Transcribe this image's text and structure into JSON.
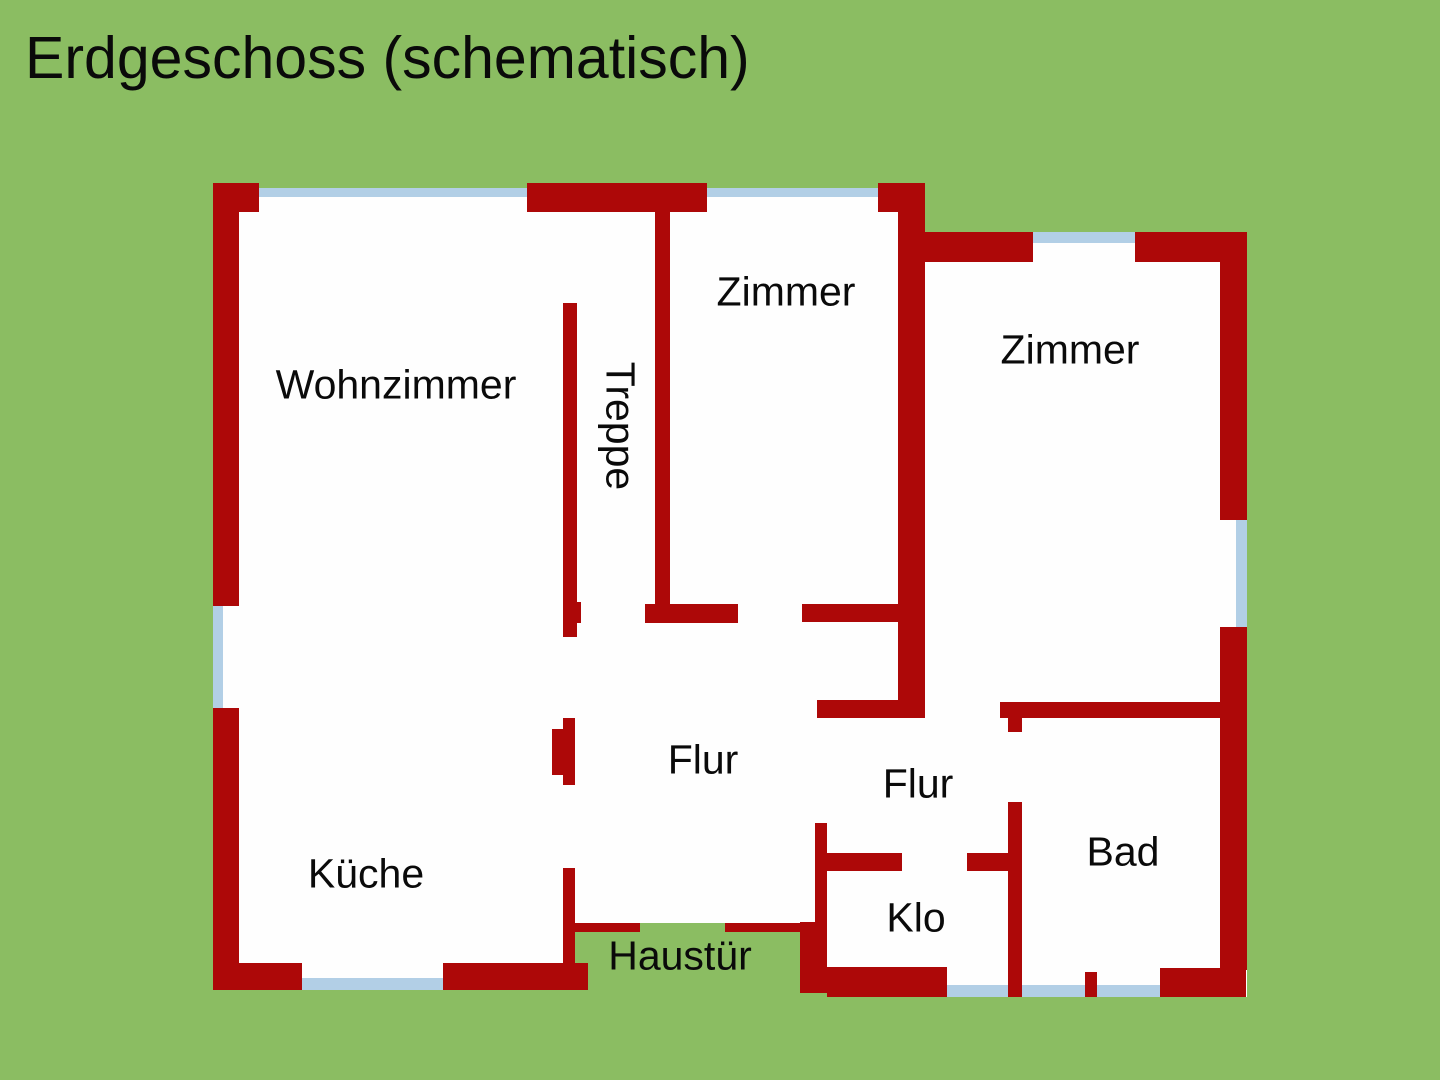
{
  "title": {
    "text": "Erdgeschoss (schematisch)"
  },
  "colors": {
    "background": "#8BBD62",
    "wall": "#AD0808",
    "window": "#B2CFE6",
    "interior": "#FEFEFE",
    "text": "#0A0A0A"
  },
  "canvas": {
    "width": 1440,
    "height": 1080
  },
  "floorplan": {
    "interior": [
      {
        "x": 213,
        "y": 183,
        "w": 712,
        "h": 807
      },
      {
        "x": 898,
        "y": 232,
        "w": 349,
        "h": 765
      }
    ],
    "green_overlays": [
      {
        "x": 259,
        "y": 183,
        "w": 268,
        "h": 5
      },
      {
        "x": 707,
        "y": 183,
        "w": 171,
        "h": 5
      },
      {
        "x": 640,
        "y": 923,
        "w": 85,
        "h": 70
      },
      {
        "x": 575,
        "y": 932,
        "w": 225,
        "h": 60
      }
    ],
    "windows": [
      {
        "name": "window-top-left",
        "x": 259,
        "y": 188,
        "w": 268,
        "h": 9
      },
      {
        "name": "window-top-middle",
        "x": 707,
        "y": 188,
        "w": 171,
        "h": 9
      },
      {
        "name": "window-top-right",
        "x": 1033,
        "y": 232,
        "w": 102,
        "h": 11
      },
      {
        "name": "window-left-wall",
        "x": 213,
        "y": 606,
        "w": 10,
        "h": 102
      },
      {
        "name": "window-right-wall",
        "x": 1236,
        "y": 520,
        "w": 11,
        "h": 107
      },
      {
        "name": "window-bottom-kueche",
        "x": 302,
        "y": 978,
        "w": 141,
        "h": 12
      },
      {
        "name": "window-bottom-klo",
        "x": 947,
        "y": 985,
        "w": 61,
        "h": 12
      },
      {
        "name": "window-bottom-bad-left",
        "x": 1022,
        "y": 985,
        "w": 63,
        "h": 12
      },
      {
        "name": "window-bottom-bad-right",
        "x": 1097,
        "y": 985,
        "w": 63,
        "h": 12
      }
    ],
    "walls": [
      {
        "name": "wall-top-left-corner",
        "x": 213,
        "y": 183,
        "w": 46,
        "h": 29
      },
      {
        "name": "wall-top-middle",
        "x": 527,
        "y": 183,
        "w": 180,
        "h": 29
      },
      {
        "name": "wall-top-block",
        "x": 878,
        "y": 183,
        "w": 47,
        "h": 29
      },
      {
        "name": "wall-left-upper",
        "x": 213,
        "y": 212,
        "w": 26,
        "h": 394
      },
      {
        "name": "wall-left-lower",
        "x": 213,
        "y": 708,
        "w": 26,
        "h": 282
      },
      {
        "name": "wall-bottom-kueche-left",
        "x": 213,
        "y": 963,
        "w": 89,
        "h": 27
      },
      {
        "name": "wall-bottom-kueche-right",
        "x": 443,
        "y": 963,
        "w": 145,
        "h": 27
      },
      {
        "name": "wall-treppe-zimmer",
        "x": 655,
        "y": 212,
        "w": 15,
        "h": 392
      },
      {
        "name": "wall-middle-vertical",
        "x": 898,
        "y": 212,
        "w": 27,
        "h": 506
      },
      {
        "name": "wall-treppe",
        "x": 563,
        "y": 303,
        "w": 14,
        "h": 334
      },
      {
        "name": "wall-treppe-nub",
        "x": 563,
        "y": 602,
        "w": 18,
        "h": 21
      },
      {
        "name": "wall-treppe-foot",
        "x": 645,
        "y": 604,
        "w": 93,
        "h": 19
      },
      {
        "name": "wall-zimmer-flur",
        "x": 802,
        "y": 604,
        "w": 96,
        "h": 18
      },
      {
        "name": "wall-middle-foot",
        "x": 817,
        "y": 700,
        "w": 106,
        "h": 18
      },
      {
        "name": "wall-door-jamb",
        "x": 563,
        "y": 718,
        "w": 12,
        "h": 67
      },
      {
        "name": "wall-door-jamb-bump",
        "x": 552,
        "y": 729,
        "w": 11,
        "h": 46
      },
      {
        "name": "wall-lower-left-vertical",
        "x": 563,
        "y": 868,
        "w": 12,
        "h": 122
      },
      {
        "name": "wall-haustuer-strip-left",
        "x": 575,
        "y": 923,
        "w": 65,
        "h": 9
      },
      {
        "name": "wall-haustuer-strip-right",
        "x": 725,
        "y": 923,
        "w": 75,
        "h": 9
      },
      {
        "name": "wall-haustuer-block",
        "x": 800,
        "y": 922,
        "w": 27,
        "h": 71
      },
      {
        "name": "wall-top-right-left",
        "x": 920,
        "y": 232,
        "w": 113,
        "h": 30
      },
      {
        "name": "wall-top-right-corner",
        "x": 1135,
        "y": 232,
        "w": 112,
        "h": 30
      },
      {
        "name": "wall-right-upper",
        "x": 1220,
        "y": 232,
        "w": 27,
        "h": 288
      },
      {
        "name": "wall-right-lower",
        "x": 1220,
        "y": 627,
        "w": 27,
        "h": 343
      },
      {
        "name": "wall-bottom-right-corner",
        "x": 1160,
        "y": 968,
        "w": 86,
        "h": 29
      },
      {
        "name": "wall-bad-top",
        "x": 1000,
        "y": 702,
        "w": 220,
        "h": 16
      },
      {
        "name": "wall-bad-left-tab",
        "x": 1008,
        "y": 718,
        "w": 14,
        "h": 14
      },
      {
        "name": "wall-bad-left",
        "x": 1008,
        "y": 802,
        "w": 14,
        "h": 195
      },
      {
        "name": "wall-klo-top-left",
        "x": 827,
        "y": 853,
        "w": 75,
        "h": 18
      },
      {
        "name": "wall-klo-top-right",
        "x": 967,
        "y": 853,
        "w": 55,
        "h": 18
      },
      {
        "name": "wall-klo-left",
        "x": 815,
        "y": 823,
        "w": 12,
        "h": 100
      },
      {
        "name": "wall-klo-bottom",
        "x": 827,
        "y": 967,
        "w": 120,
        "h": 30
      },
      {
        "name": "wall-window-divider-tab",
        "x": 1085,
        "y": 972,
        "w": 12,
        "h": 25
      }
    ],
    "labels": [
      {
        "name": "wohnzimmer",
        "text": "Wohnzimmer",
        "cx": 396,
        "cy": 385,
        "rot": 0
      },
      {
        "name": "treppe",
        "text": "Treppe",
        "cx": 620,
        "cy": 426,
        "rot": 90
      },
      {
        "name": "zimmer-1",
        "text": "Zimmer",
        "cx": 786,
        "cy": 292,
        "rot": 0
      },
      {
        "name": "zimmer-2",
        "text": "Zimmer",
        "cx": 1070,
        "cy": 350,
        "rot": 0
      },
      {
        "name": "flur-1",
        "text": "Flur",
        "cx": 703,
        "cy": 760,
        "rot": 0
      },
      {
        "name": "flur-2",
        "text": "Flur",
        "cx": 918,
        "cy": 784,
        "rot": 0
      },
      {
        "name": "kueche",
        "text": "Küche",
        "cx": 366,
        "cy": 874,
        "rot": 0
      },
      {
        "name": "klo",
        "text": "Klo",
        "cx": 916,
        "cy": 918,
        "rot": 0
      },
      {
        "name": "bad",
        "text": "Bad",
        "cx": 1123,
        "cy": 852,
        "rot": 0
      },
      {
        "name": "haustuer",
        "text": "Haustür",
        "cx": 680,
        "cy": 956,
        "rot": 0
      }
    ]
  }
}
